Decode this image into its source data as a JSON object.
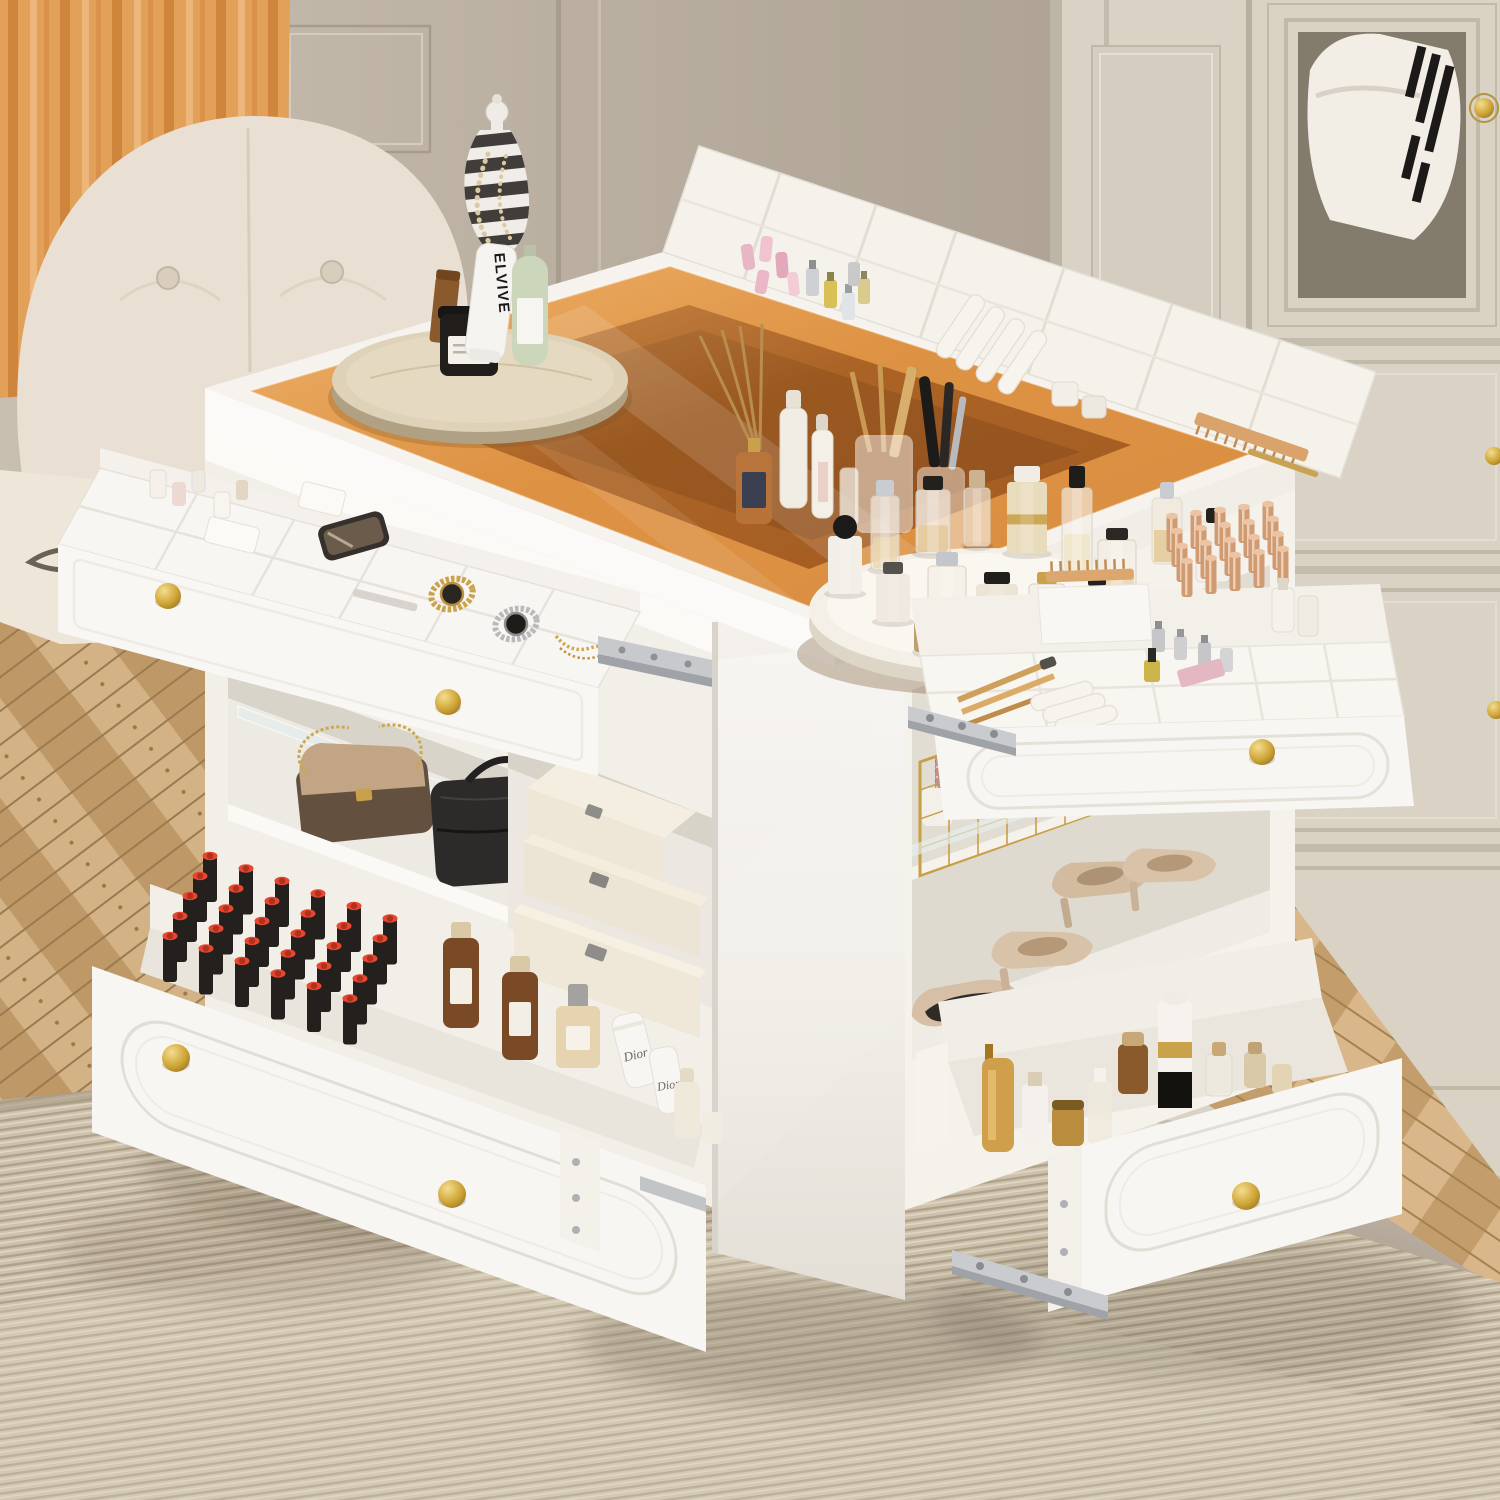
{
  "texts": {
    "tube_brand": "ELVIVE",
    "cream_brand": "Dior"
  },
  "palette": {
    "curtain": "#e8a55f",
    "wall": "#b7ac9e",
    "wardrobe": "#d9d2c5",
    "glass": "#d98a3a",
    "glass_deep": "#a05518",
    "island_white": "#f7f5f1",
    "gold": "#c9a24a",
    "rug": "#cdc2ae",
    "wood": "#c9a678",
    "lipstick_red": "#e6472e",
    "leather_chair": "#e9dfd3"
  },
  "counts": {
    "open_drawers": 4,
    "gold_knobs": 8,
    "left_drawer_lipsticks": 30,
    "right_drawer_rose_tubes": 20,
    "lazy_susan_items": 14,
    "handbags": 2,
    "storage_boxes": 3,
    "heels_pairs": 2,
    "watches": 2
  },
  "gen": {
    "lipsticks": {
      "rows": 5,
      "cols": 6,
      "start": [
        210,
        902
      ],
      "col_step": [
        36,
        12.5
      ],
      "row_step": [
        -10,
        20
      ],
      "body": "#23201d",
      "top": "#e6472e",
      "top_dark": "#b23020"
    },
    "rose_tubes": {
      "rows": 4,
      "cols": 5,
      "start": [
        1172,
        552
      ],
      "col_step": [
        24,
        -3
      ],
      "row_step": [
        5,
        15
      ],
      "body": "#d09a72",
      "top": "#ecc4a4",
      "highlight": "#f4ddc6"
    },
    "lazy_susan_bottles": [
      {
        "dx": -100,
        "dy": -42,
        "w": 28,
        "h": 74,
        "body": "clear",
        "cap": "#c9ccd0",
        "capW": 18,
        "capH": 16,
        "liquid": "#e9d6ae"
      },
      {
        "dx": -52,
        "dy": -58,
        "w": 34,
        "h": 64,
        "body": "clear",
        "cap": "#23211e",
        "capW": 20,
        "capH": 14,
        "liquid": "#e3c694"
      },
      {
        "dx": -8,
        "dy": -66,
        "w": 26,
        "h": 58,
        "body": "clear",
        "cap": "#cbb391",
        "capW": 16,
        "capH": 18
      },
      {
        "dx": 42,
        "dy": -58,
        "w": 40,
        "h": 72,
        "body": "#e9dcbd",
        "cap": "#f1ede4",
        "capW": 26,
        "capH": 16,
        "band": "#c9a24a"
      },
      {
        "dx": 92,
        "dy": -40,
        "w": 30,
        "h": 84,
        "body": "clear",
        "cap": "#1f1d1a",
        "capW": 16,
        "capH": 22,
        "liquid": "#efe3c2"
      },
      {
        "dx": -140,
        "dy": -18,
        "w": 34,
        "h": 58,
        "body": "#f2efe9",
        "capShape": "ball",
        "cap": "#1d1b19",
        "capR": 12
      },
      {
        "dx": 132,
        "dy": -16,
        "w": 38,
        "h": 56,
        "body": "clear",
        "cap": "#2a2724",
        "capW": 22,
        "capH": 12,
        "liquid": "#e8d3a8"
      },
      {
        "dx": -92,
        "dy": 10,
        "w": 34,
        "h": 48,
        "body": "#efe9df",
        "cap": "#55514c",
        "capW": 20,
        "capH": 12
      },
      {
        "dx": -38,
        "dy": 16,
        "w": 38,
        "h": 62,
        "body": "clear",
        "cap": "#c3c6ca",
        "capW": 22,
        "capH": 14,
        "liquid": "#f3e8cf"
      },
      {
        "dx": 12,
        "dy": 22,
        "w": 42,
        "h": 50,
        "body": "#ece4d6",
        "cap": "#211f1c",
        "capW": 26,
        "capH": 12
      },
      {
        "dx": 62,
        "dy": 26,
        "w": 36,
        "h": 54,
        "body": "clear",
        "cap": "#c9a24a",
        "capW": 20,
        "capH": 12,
        "liquid": "#e6cf9e"
      },
      {
        "dx": 112,
        "dy": 18,
        "w": 30,
        "h": 44,
        "body": "#f1ece4",
        "cap": "#23211f",
        "capW": 18,
        "capH": 10
      },
      {
        "dx": -64,
        "dy": 40,
        "w": 14,
        "h": 34,
        "body": "#bf9f6e",
        "cap": "#1f1d1b",
        "capW": 12,
        "capH": 10
      },
      {
        "dx": -18,
        "dy": 50,
        "w": 54,
        "h": 44,
        "shape": "triangle",
        "body": "#e7c4b5",
        "cap": "#1d1b19",
        "capW": 16,
        "capH": 10
      }
    ]
  }
}
